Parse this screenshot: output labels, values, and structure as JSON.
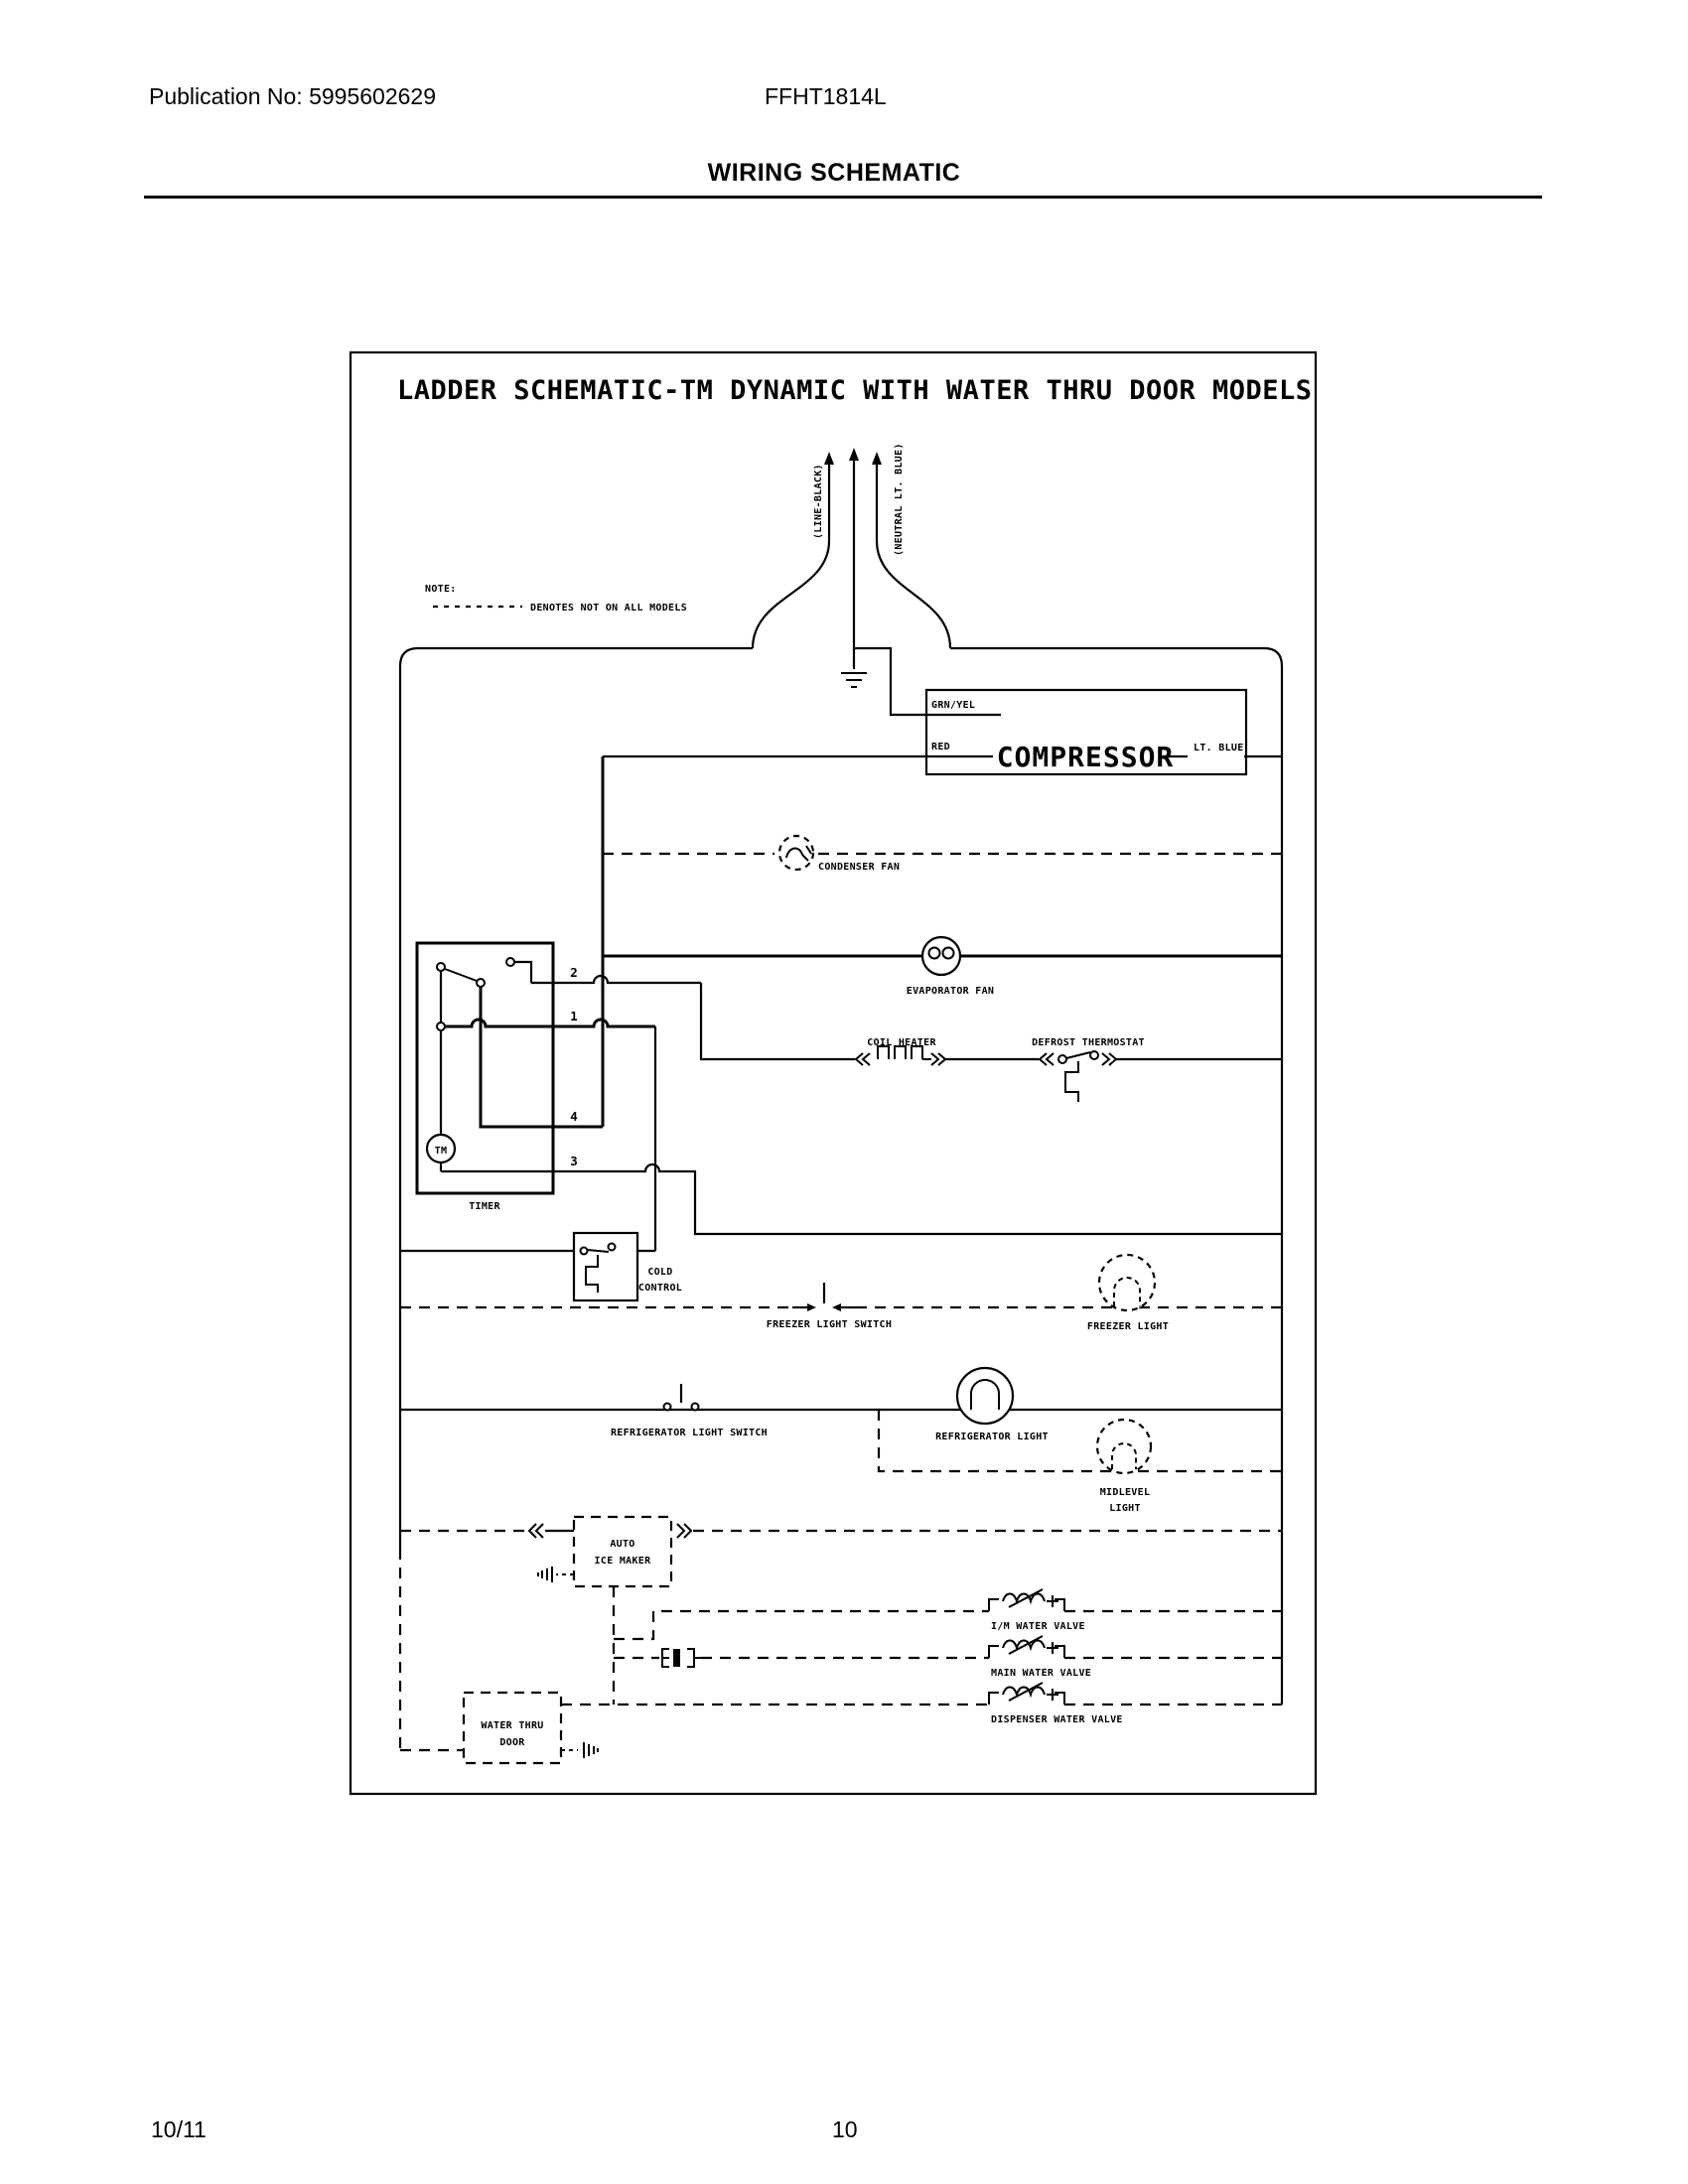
{
  "page": {
    "publication": "Publication No: 5995602629",
    "model": "FFHT1814L",
    "title": "WIRING SCHEMATIC",
    "footer_left": "10/11",
    "footer_page": "10"
  },
  "schematic": {
    "title": "LADDER SCHEMATIC-TM DYNAMIC WITH WATER THRU DOOR MODELS",
    "note_label": "NOTE:",
    "note_text": "DENOTES NOT ON ALL MODELS",
    "power": {
      "line": "(LINE-BLACK)",
      "neutral": "(NEUTRAL LT. BLUE)"
    },
    "compressor": {
      "name": "COMPRESSOR",
      "lead_top": "GRN/YEL",
      "lead_left": "RED",
      "lead_right": "LT. BLUE"
    },
    "condenser_fan": "CONDENSER FAN",
    "evaporator_fan": "EVAPORATOR FAN",
    "coil_heater": "COIL HEATER",
    "defrost_thermostat": "DEFROST THERMOSTAT",
    "timer": {
      "name": "TIMER",
      "motor": "TM",
      "terminals": [
        "2",
        "1",
        "4",
        "3"
      ]
    },
    "cold_control": {
      "line1": "COLD",
      "line2": "CONTROL"
    },
    "freezer_light_switch": "FREEZER LIGHT SWITCH",
    "freezer_light": "FREEZER LIGHT",
    "refrigerator_light_switch": "REFRIGERATOR LIGHT SWITCH",
    "refrigerator_light": "REFRIGERATOR LIGHT",
    "midlevel_light": {
      "line1": "MIDLEVEL",
      "line2": "LIGHT"
    },
    "auto_ice_maker": {
      "line1": "AUTO",
      "line2": "ICE MAKER"
    },
    "im_water_valve": "I/M WATER VALVE",
    "main_water_valve": "MAIN WATER VALVE",
    "dispenser_water_valve": "DISPENSER WATER VALVE",
    "water_thru_door": {
      "line1": "WATER THRU",
      "line2": "DOOR"
    }
  }
}
